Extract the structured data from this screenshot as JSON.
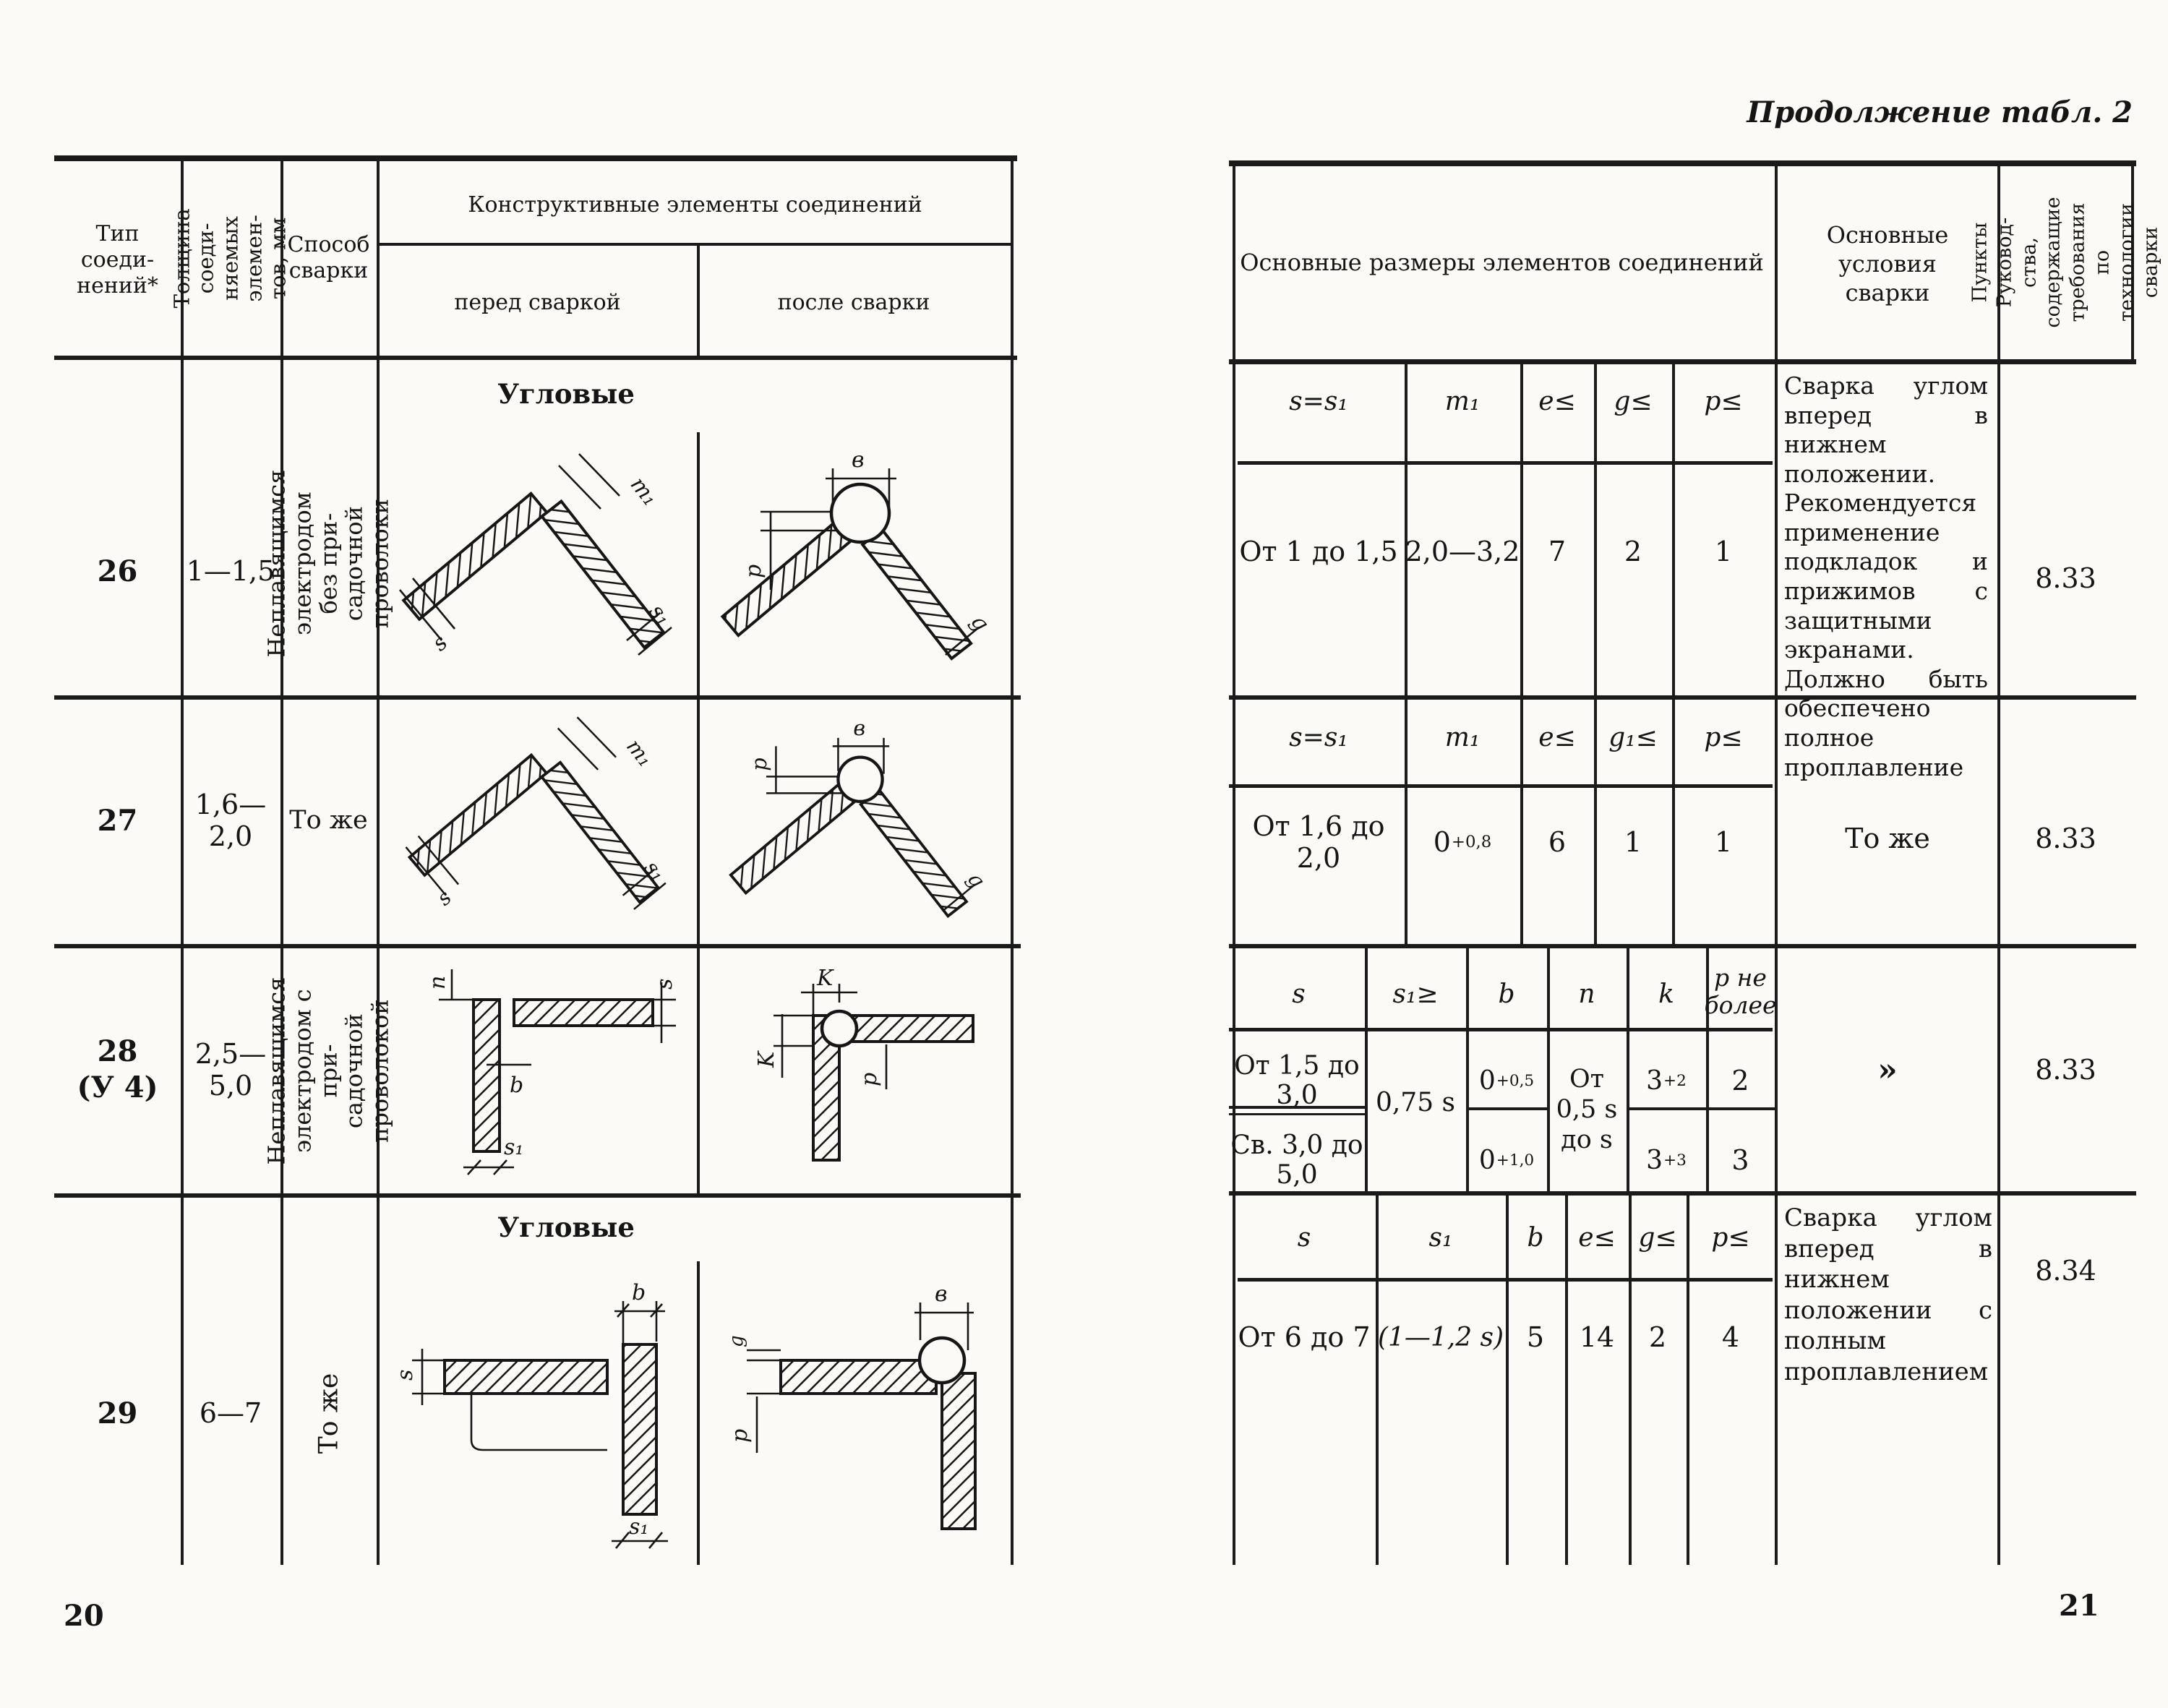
{
  "left_page": {
    "page_number": "20",
    "header": {
      "type": "Тип\nсоеди-\nнений*",
      "thickness": "Толщина соеди-\nняемых элемен-\nтов, мм",
      "method": "Способ\nсварки",
      "elements": "Конструктивные элементы соединений",
      "before": "перед сваркой",
      "after": "после сварки"
    },
    "sections": [
      "Угловые",
      "Угловые"
    ],
    "rows": [
      {
        "type": "26",
        "thickness": "1—1,5",
        "method": "Неплавящимся\nэлектродом без при-\nсадочной проволоки"
      },
      {
        "type": "27",
        "thickness": "1,6—2,0",
        "method": "То же"
      },
      {
        "type": "28\n(У 4)",
        "thickness": "2,5—5,0",
        "method": "Неплавящимся\nэлектродом с при-\nсадочной проволокой"
      },
      {
        "type": "29",
        "thickness": "6—7",
        "method": "То же"
      }
    ],
    "diagrams": {
      "v_before": {
        "m1": "m₁",
        "s": "s",
        "s1": "s₁"
      },
      "v_after": {
        "e": "в",
        "p": "p",
        "g": "g"
      },
      "corner_before": {
        "n": "n",
        "s": "s",
        "b": "b",
        "s1": "s₁"
      },
      "corner_after": {
        "k1": "K",
        "k2": "K",
        "p": "p"
      },
      "tee_before": {
        "b": "b",
        "s": "s",
        "s1": "s₁"
      },
      "tee_after": {
        "e": "в",
        "g": "g",
        "p": "p"
      }
    }
  },
  "right_page": {
    "page_number": "21",
    "continuation": "Продолжение табл. 2",
    "header": {
      "dimensions": "Основные размеры элементов соединений",
      "conditions": "Основные условия\nсварки",
      "points": "Пункты Руковод-\nства, содержащие\nтребования по\nтехнологии сварки"
    },
    "block1": {
      "headers": [
        "s=s₁",
        "m₁",
        "e≤",
        "g≤",
        "p≤"
      ],
      "values": {
        "s": "От 1 до 1,5",
        "m1": "2,0—3,2",
        "e": "7",
        "g": "2",
        "p": "1"
      },
      "conditions": "Сварка углом вперед в нижнем положении. Рекомендуется применение подкладок и прижимов с защитными экранами. Должно быть обеспечено полное проплавление",
      "point": "8.33"
    },
    "block2": {
      "headers": [
        "s=s₁",
        "m₁",
        "e≤",
        "g₁≤",
        "p≤"
      ],
      "values": {
        "s": "От 1,6 до 2,0",
        "m1_base": "0",
        "m1_sup": "+0,8",
        "e": "6",
        "g1": "1",
        "p": "1"
      },
      "conditions": "То же",
      "point": "8.33"
    },
    "block3": {
      "headers": [
        "s",
        "s₁≥",
        "b",
        "n",
        "k",
        "p не\nболее"
      ],
      "s1": "0,75 s",
      "n": "От\n0,5 s\nдо s",
      "row1": {
        "s": "От 1,5 до 3,0",
        "b_base": "0",
        "b_sup": "+0,5",
        "k_base": "3",
        "k_sup": "+2",
        "p": "2"
      },
      "row2": {
        "s": "Св. 3,0 до 5,0",
        "b_base": "0",
        "b_sup": "+1,0",
        "k_base": "3",
        "k_sup": "+3",
        "p": "3"
      },
      "conditions": "»",
      "point": "8.33"
    },
    "block4": {
      "headers": [
        "s",
        "s₁",
        "b",
        "e≤",
        "g≤",
        "p≤"
      ],
      "values": {
        "s": "От 6 до 7",
        "s1": "(1—1,2 s)",
        "b": "5",
        "e": "14",
        "g": "2",
        "p": "4"
      },
      "conditions": "Сварка углом вперед в нижнем положении с полным проплавлением",
      "point": "8.34"
    }
  }
}
